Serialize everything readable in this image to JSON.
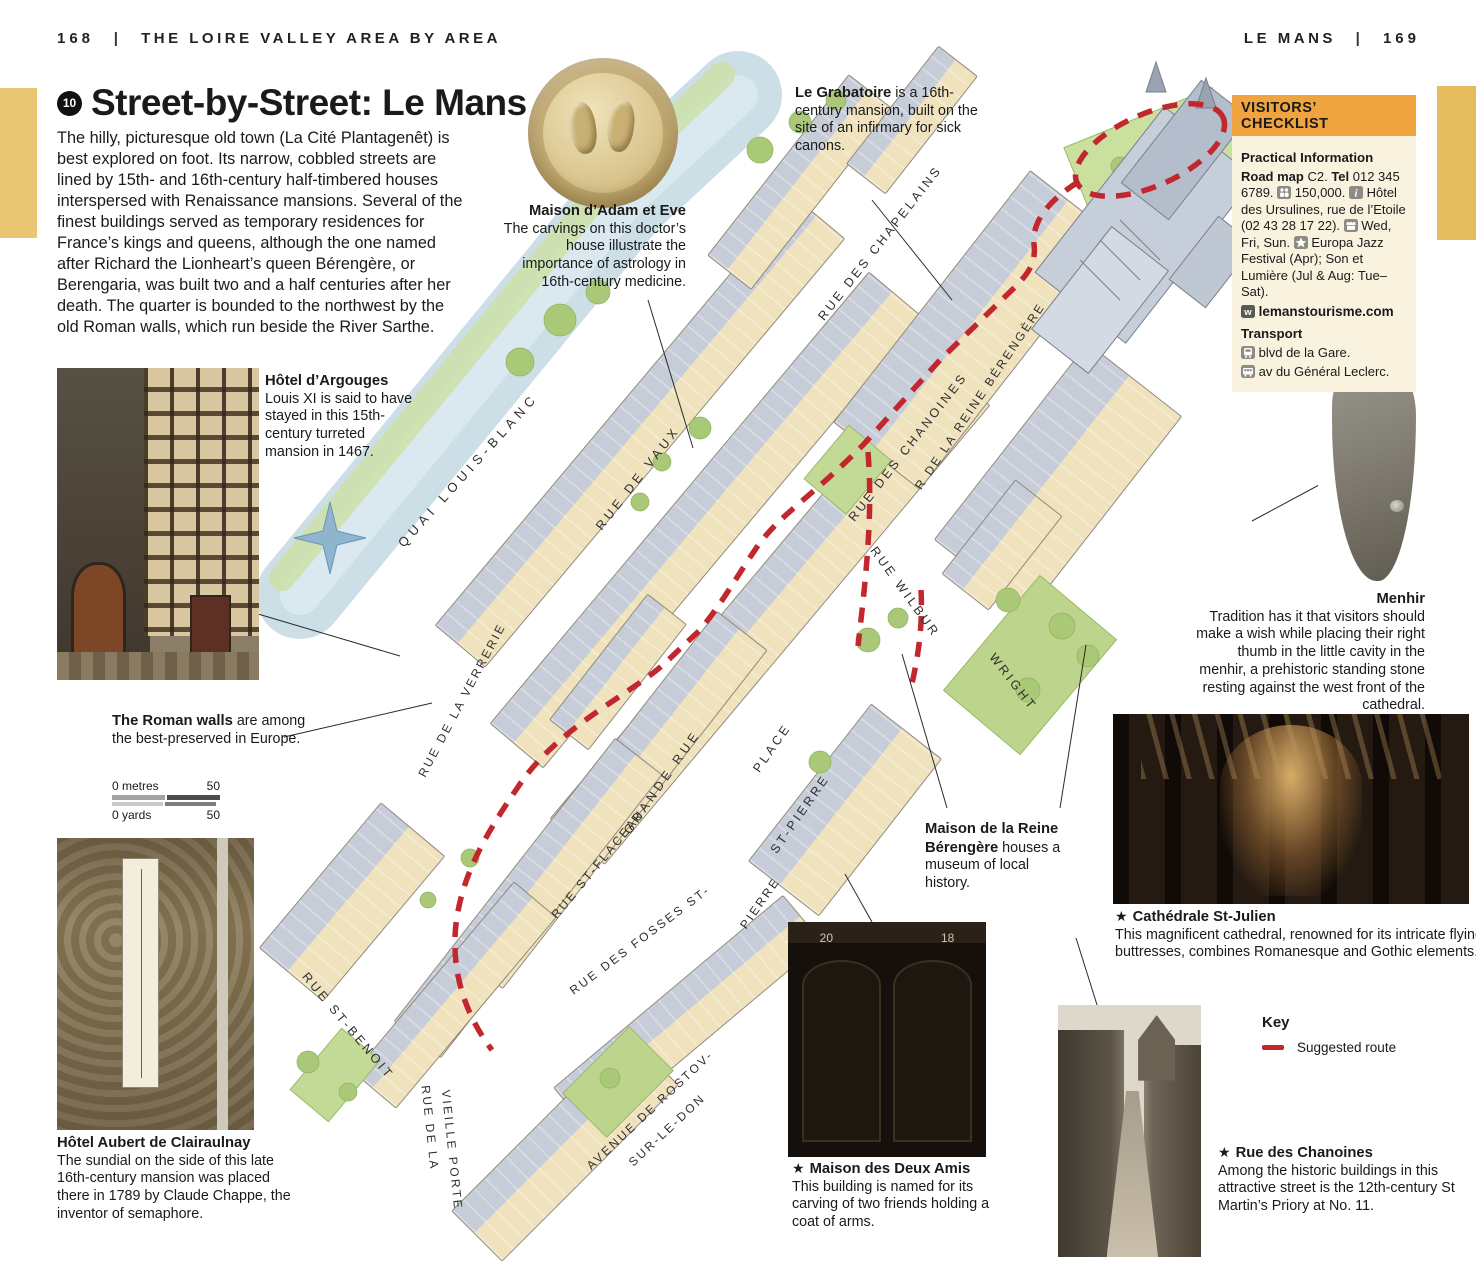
{
  "page_header": {
    "left_page_number": "168",
    "left_title": "THE LOIRE VALLEY AREA BY AREA",
    "right_title": "LE MANS",
    "right_page_number": "169",
    "divider": "|"
  },
  "intro": {
    "badge": "10",
    "title": "Street-by-Street: Le Mans",
    "body": "The hilly, picturesque old town (La Cité Plantagenêt) is best explored on foot. Its narrow, cobbled streets are lined by 15th- and 16th-century half-timbered houses interspersed with Renaissance mansions. Several of the finest buildings served as temporary residences for France’s kings and queens, although the one named after Richard the Lionheart’s queen Bérengère, or Berengaria, was built two and a half centuries after her death. The quarter is bounded to the northwest by the old Roman walls, which run beside the River Sarthe."
  },
  "annotations": {
    "adam_eve": {
      "title": "Maison d’Adam et Eve",
      "body": "The carvings on this doctor’s house illustrate the importance of astrology in 16th-century medicine."
    },
    "grabatoire": {
      "title": "Le Grabatoire",
      "body": " is a 16th-century mansion, built on the site of an infirmary for sick canons."
    },
    "argouges": {
      "title": "Hôtel d’Argouges",
      "body": "Louis XI is said to have stayed in this 15th-century turreted mansion in 1467."
    },
    "menhir": {
      "title": "Menhir",
      "body": "Tradition has it that visitors should make a wish while placing their right thumb in the little cavity in the menhir, a prehistoric standing stone resting against the west front of the cathedral."
    },
    "roman_walls": {
      "title": "The Roman walls",
      "body": " are among the best-preserved in Europe."
    },
    "reine_berengere": {
      "title": "Maison de la Reine Bérengère",
      "body": " houses a museum of local history."
    },
    "cathedrale": {
      "star": "★",
      "title": "Cathédrale St-Julien",
      "body": "This magnificent cathedral, renowned for its intricate flying buttresses, combines Romanesque and Gothic elements."
    },
    "deux_amis": {
      "star": "★",
      "title": "Maison des Deux Amis",
      "body": "This building is named for its carving of two friends holding a coat of arms."
    },
    "chanoines": {
      "star": "★",
      "title": "Rue des Chanoines",
      "body": "Among the historic buildings in this attractive street is the 12th-century St Martin’s Priory at No. 11."
    },
    "aubert": {
      "title": "Hôtel Aubert de Clairaulnay",
      "body": "The sundial on the side of this late 16th-century mansion was placed there in 1789 by Claude Chappe, the inventor of semaphore."
    }
  },
  "checklist": {
    "header": "VISITORS’ CHECKLIST",
    "practical_title": "Practical Information",
    "road_map_label": "Road map",
    "road_map_value": " C2. ",
    "tel_label": "Tel",
    "tel_value": " 012 345 6789. ",
    "population": " 150,000. ",
    "info_text": " Hôtel des Ursulines, rue de l’Etoile (02 43 28 17 22). ",
    "market_days": " Wed, Fri, Sun. ",
    "festivals": " Europa Jazz Festival (Apr); Son et Lumière (Jul & Aug: Tue–Sat).",
    "website": "lemanstourisme.com",
    "transport_title": "Transport",
    "train_stop": " blvd de la Gare.",
    "bus_stop": " av du Général Leclerc."
  },
  "key": {
    "title": "Key",
    "route_label": "Suggested route"
  },
  "scale_bar": {
    "metres_label": "0 metres",
    "metres_value": "50",
    "yards_label": "0 yards",
    "yards_value": "50"
  },
  "photos": {
    "deux_amis_numbers": [
      "20",
      "18"
    ]
  },
  "map": {
    "street_labels": [
      {
        "label": "QUAI LOUIS-BLANC",
        "x": 468,
        "y": 470,
        "angle": -48,
        "ls": 5,
        "fs": 13
      },
      {
        "label": "RUE DES CHAPELAINS",
        "x": 880,
        "y": 243,
        "angle": -52,
        "ls": 3,
        "fs": 12.5
      },
      {
        "label": "RUE DES CHANOINES",
        "x": 908,
        "y": 447,
        "angle": -52,
        "ls": 3,
        "fs": 12.5
      },
      {
        "label": "R DE LA REINE BÉRENGÈRE",
        "x": 980,
        "y": 396,
        "angle": -56,
        "ls": 2.5,
        "fs": 12
      },
      {
        "label": "RUE DE VAUX",
        "x": 638,
        "y": 478,
        "angle": -52,
        "ls": 4,
        "fs": 12.5
      },
      {
        "label": "GRANDE RUE",
        "x": 662,
        "y": 782,
        "angle": -55,
        "ls": 4,
        "fs": 12.5
      },
      {
        "label": "PLACE",
        "x": 772,
        "y": 748,
        "angle": -55,
        "ls": 3,
        "fs": 12.5
      },
      {
        "label": "ST-PIERRE",
        "x": 800,
        "y": 814,
        "angle": -55,
        "ls": 3,
        "fs": 12.5
      },
      {
        "label": "RUE WILBUR",
        "x": 905,
        "y": 592,
        "angle": 54,
        "ls": 3,
        "fs": 12.5
      },
      {
        "label": "WRIGHT",
        "x": 1013,
        "y": 682,
        "angle": 52,
        "ls": 3,
        "fs": 12.5
      },
      {
        "label": "RUE DE LA VERRERIE",
        "x": 462,
        "y": 700,
        "angle": -62,
        "ls": 2.5,
        "fs": 12
      },
      {
        "label": "RUE ST-FLACEAU",
        "x": 598,
        "y": 864,
        "angle": -50,
        "ls": 2.5,
        "fs": 12
      },
      {
        "label": "RUE DES FOSSES ST-",
        "x": 640,
        "y": 940,
        "angle": -37,
        "ls": 2.5,
        "fs": 12
      },
      {
        "label": "PIERRE",
        "x": 760,
        "y": 903,
        "angle": -55,
        "ls": 2.5,
        "fs": 12
      },
      {
        "label": "RUE ST-BENOIT",
        "x": 348,
        "y": 1026,
        "angle": 50,
        "ls": 3,
        "fs": 12.5
      },
      {
        "label": "RUE DE LA",
        "x": 430,
        "y": 1128,
        "angle": 84,
        "ls": 2.5,
        "fs": 12
      },
      {
        "label": "VIEILLE PORTE",
        "x": 452,
        "y": 1150,
        "angle": 84,
        "ls": 2.5,
        "fs": 12
      },
      {
        "label": "AVENUE DE ROSTOV-",
        "x": 650,
        "y": 1110,
        "angle": -43,
        "ls": 2.5,
        "fs": 12
      },
      {
        "label": "SUR-LE-DON",
        "x": 667,
        "y": 1130,
        "angle": -43,
        "ls": 2.5,
        "fs": 12
      }
    ]
  }
}
